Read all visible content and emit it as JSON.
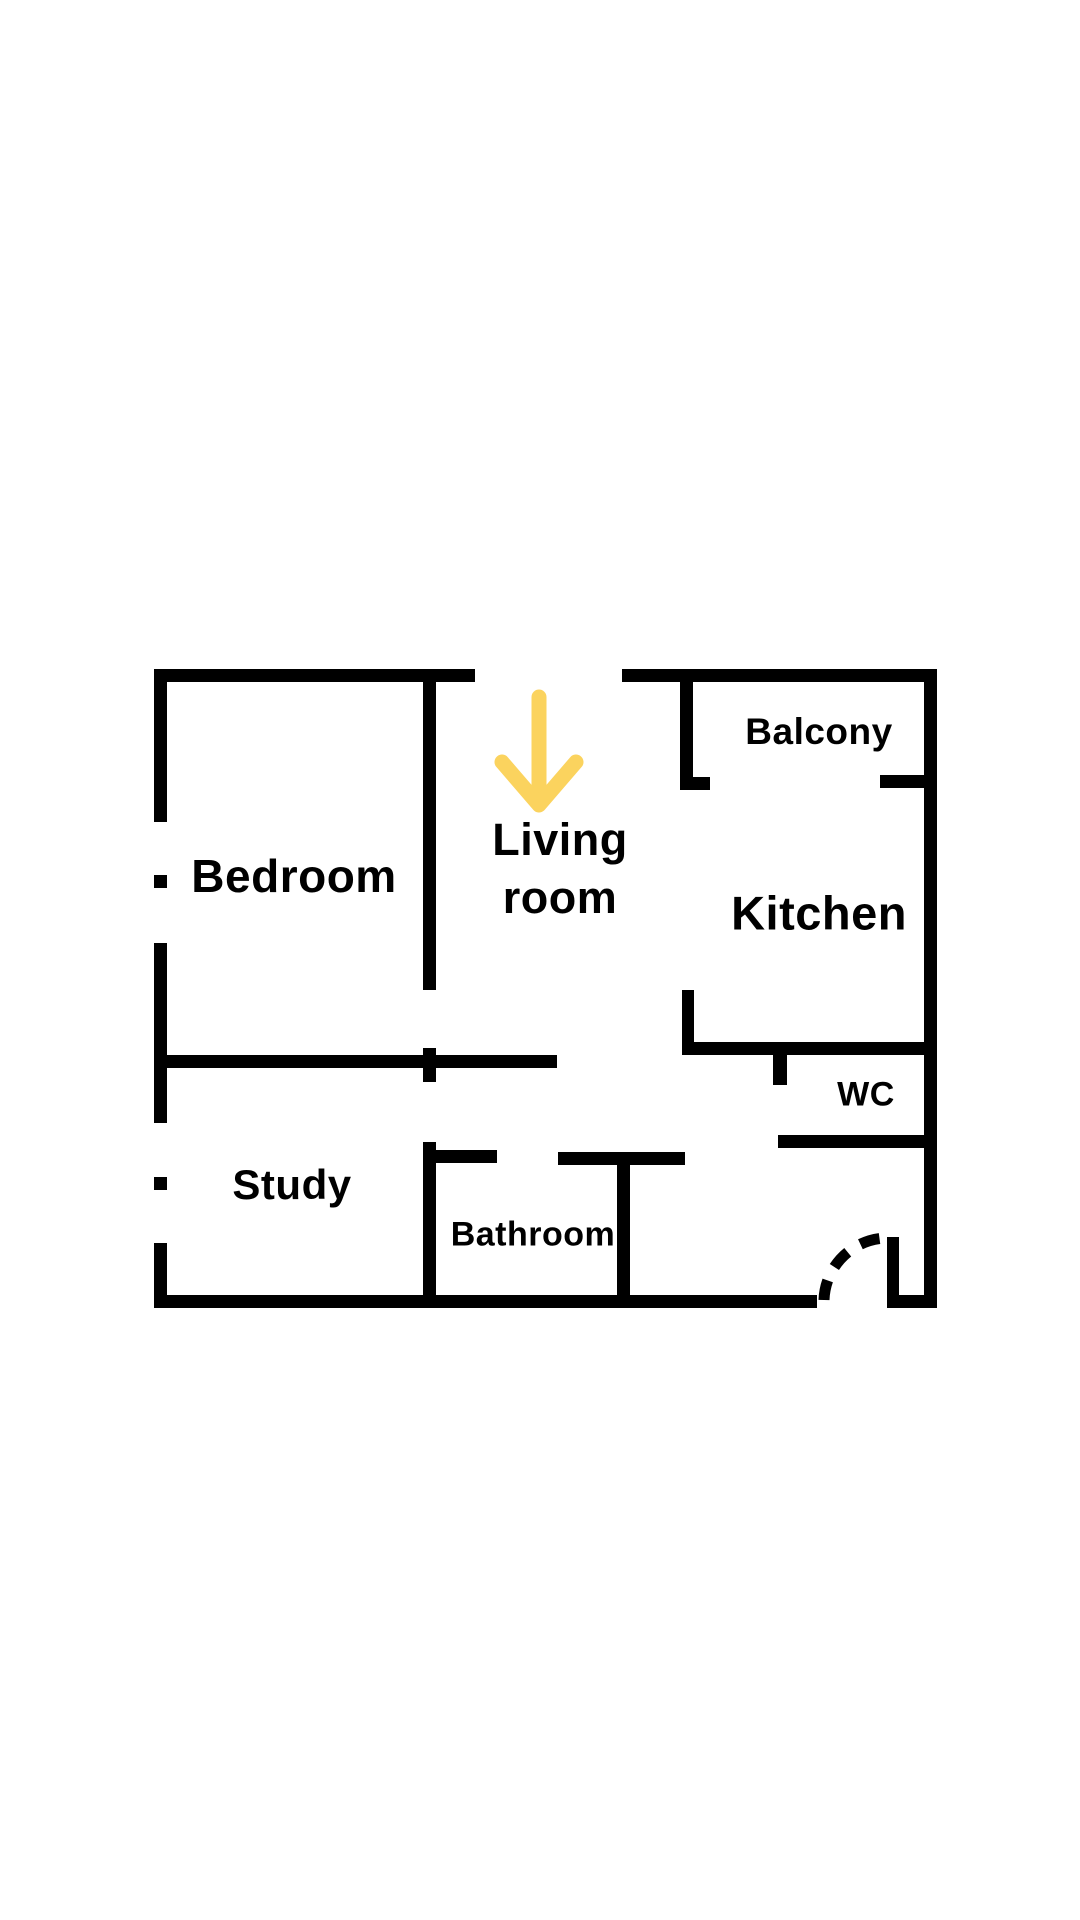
{
  "page": {
    "background_color": "#ffffff",
    "type": "floor-plan-diagram"
  },
  "floor_plan": {
    "wall_color": "#000000",
    "text_color": "#000000",
    "labels": {
      "bedroom": "Bedroom",
      "living_line1": "Living",
      "living_line2": "room",
      "balcony": "Balcony",
      "kitchen": "Kitchen",
      "wc": "WC",
      "study": "Study",
      "bathroom": "Bathroom"
    },
    "rooms": [
      {
        "name": "Bedroom"
      },
      {
        "name": "Living room"
      },
      {
        "name": "Balcony"
      },
      {
        "name": "Kitchen"
      },
      {
        "name": "WC"
      },
      {
        "name": "Study"
      },
      {
        "name": "Bathroom"
      }
    ],
    "arrow": {
      "icon": "down-arrow",
      "color": "#FBD35E",
      "points_to": "Living room"
    },
    "entrance": {
      "symbol": "dashed-door-swing-arc"
    }
  }
}
